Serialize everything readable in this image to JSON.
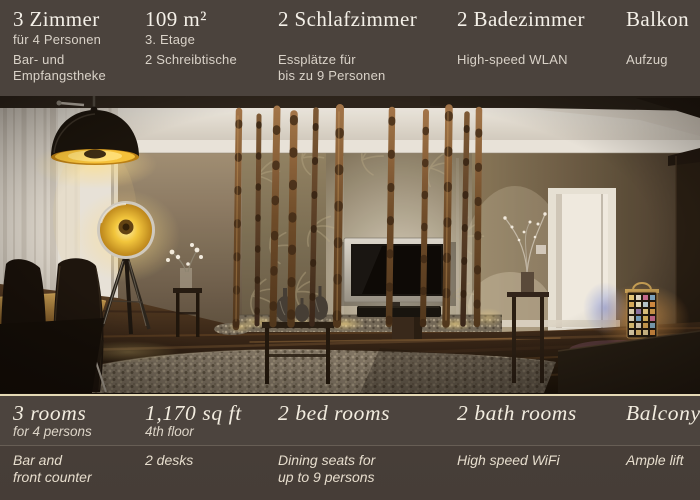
{
  "colors": {
    "bar_background": "#4b433d",
    "footer_background_top": "#4c443e",
    "footer_background_bottom": "#463d37",
    "separator_line": "#e5d9b5",
    "heading_text": "#f4f0e8",
    "body_text": "#d9d2c8",
    "lamp_glow": "#f6c33c"
  },
  "info_bar_de": {
    "columns": [
      {
        "heading": "3 Zimmer",
        "sub": "für 4 Personen",
        "features": [
          "Bar- und",
          "Empfangstheke"
        ]
      },
      {
        "heading": "109 m²",
        "sub": "3. Etage",
        "features": [
          "2 Schreibtische"
        ]
      },
      {
        "heading": "2 Schlafzimmer",
        "sub": "",
        "features": [
          "Essplätze für",
          "bis zu 9 Personen"
        ]
      },
      {
        "heading": "2 Badezimmer",
        "sub": "",
        "features": [
          "High-speed WLAN"
        ]
      },
      {
        "heading": "Balkon",
        "sub": "",
        "features": [
          "Aufzug"
        ]
      }
    ]
  },
  "info_bar_en": {
    "columns": [
      {
        "heading": "3 rooms",
        "sub": "for 4 persons",
        "features": [
          "Bar and",
          "front counter"
        ]
      },
      {
        "heading": "1,170 sq ft",
        "sub": "4th floor",
        "features": [
          "2 desks"
        ]
      },
      {
        "heading": "2 bed rooms",
        "sub": "",
        "features": [
          "Dining seats for",
          "up to 9 persons"
        ]
      },
      {
        "heading": "2 bath rooms",
        "sub": "",
        "features": [
          "High speed WiFi"
        ]
      },
      {
        "heading": "Balcony",
        "sub": "",
        "features": [
          "Ample lift"
        ]
      }
    ]
  }
}
